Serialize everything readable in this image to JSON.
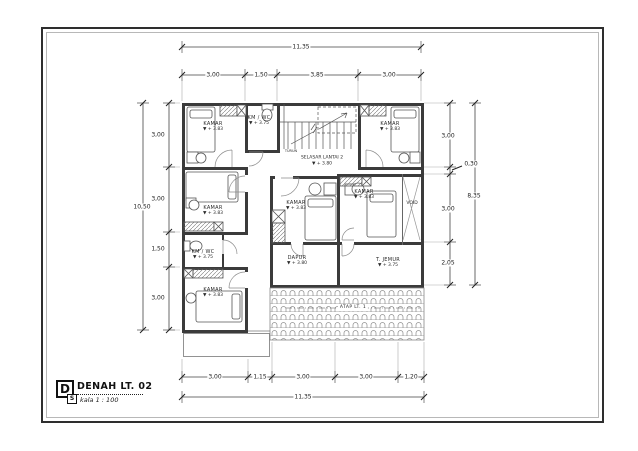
{
  "sheet": {
    "title_block": {
      "drawing_letter": "D",
      "title": "DENAH LT. 02",
      "scale_prefix": "S",
      "scale_text": "kala 1 : 100"
    }
  },
  "plan": {
    "rooms": {
      "kamar_top_left": {
        "name": "KAMAR",
        "level": "▼ + 3.83"
      },
      "kmwc_top": {
        "name": "KM / WC",
        "level": "▼ + 3.75"
      },
      "kamar_top_right": {
        "name": "KAMAR",
        "level": "▼ + 3.83"
      },
      "selasar": {
        "name": "SELASAR LANTAI 2",
        "level": "▼ + 3.80"
      },
      "kamar_mid_left": {
        "name": "KAMAR",
        "level": "▼ + 3.83"
      },
      "kamar_center": {
        "name": "KAMAR",
        "level": "▼ + 3.83"
      },
      "kamar_mid_right": {
        "name": "KAMAR",
        "level": "▼ + 3.83"
      },
      "void": {
        "name": "VOID"
      },
      "kmwc_left": {
        "name": "KM / WC",
        "level": "▼ + 3.75"
      },
      "dapur": {
        "name": "DAPUR",
        "level": "▼ + 3.80"
      },
      "t_jemur": {
        "name": "T. JEMUR",
        "level": "▼ + 3.75"
      },
      "kamar_bottom_left": {
        "name": "KAMAR",
        "level": "▼ + 3.83"
      },
      "atap": {
        "name": "ATAP LT. 1"
      },
      "stairs_note": "TURUN"
    },
    "dimensions": {
      "top_total": "11,35",
      "top_segments": [
        "3,00",
        "1,50",
        "3,85",
        "3,00"
      ],
      "bottom_total": "11,35",
      "bottom_segments": [
        "3,00",
        "1,15",
        "3,00",
        "3,00",
        "1,20"
      ],
      "left_total": "10,50",
      "left_segments": [
        "3,00",
        "3,00",
        "1,50",
        "3,00"
      ],
      "right_total": "8,35",
      "right_segments": [
        "3,00",
        "0,30",
        "3,00",
        "2,05"
      ]
    }
  }
}
